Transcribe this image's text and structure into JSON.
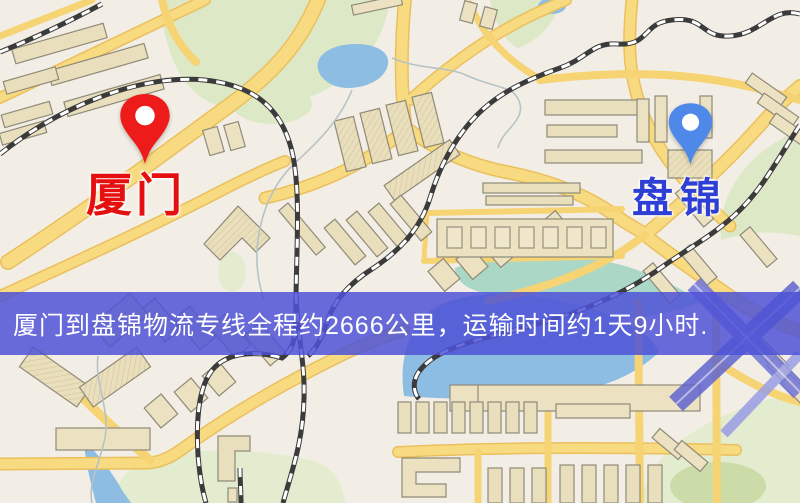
{
  "map": {
    "origin": {
      "name": "厦门",
      "pin_color": "#ee1b1b",
      "label_color": "#e60f0f"
    },
    "destination": {
      "name": "盘锦",
      "pin_color": "#4e89ea",
      "label_color": "#2e3fd6"
    }
  },
  "banner": {
    "text": "厦门到盘锦物流专线全程约2666公里，运输时间约1天9小时.",
    "background": "rgba(77,82,214,0.85)",
    "text_color": "#ffffff"
  },
  "palette": {
    "map_background": "#f3eee5",
    "road_yellow": "#f6d373",
    "park_green": "#dde8c7",
    "water_blue": "#8dbde2",
    "water_teal": "#abd7c6",
    "building_beige": "#ece2c2",
    "railway_dark": "#3b3b3b",
    "expressway_blue": "#6065cf"
  }
}
